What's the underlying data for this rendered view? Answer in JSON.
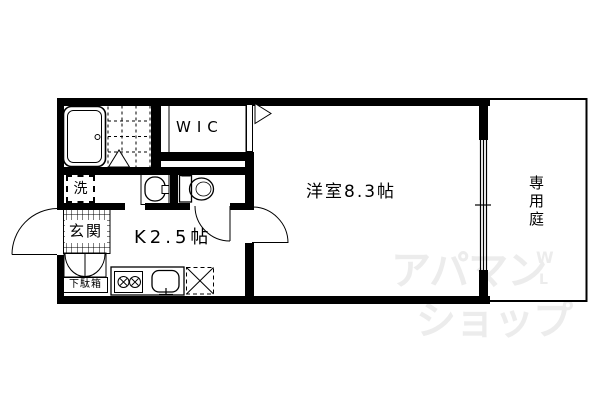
{
  "title": "apartment-floor-plan",
  "labels": {
    "wic": "WIC",
    "washer": "洗",
    "genkan": "玄関",
    "shoe_cabinet": "下駄箱",
    "kitchen": "K2.5帖",
    "western_room": "洋室8.3帖",
    "private_garden": "専用庭"
  },
  "watermark": {
    "line1": "アパマン",
    "line2": "ショップ",
    "mark_w": "W",
    "mark_l": "L",
    "color": "#ececec"
  },
  "colors": {
    "line": "#000000",
    "background": "#ffffff"
  }
}
